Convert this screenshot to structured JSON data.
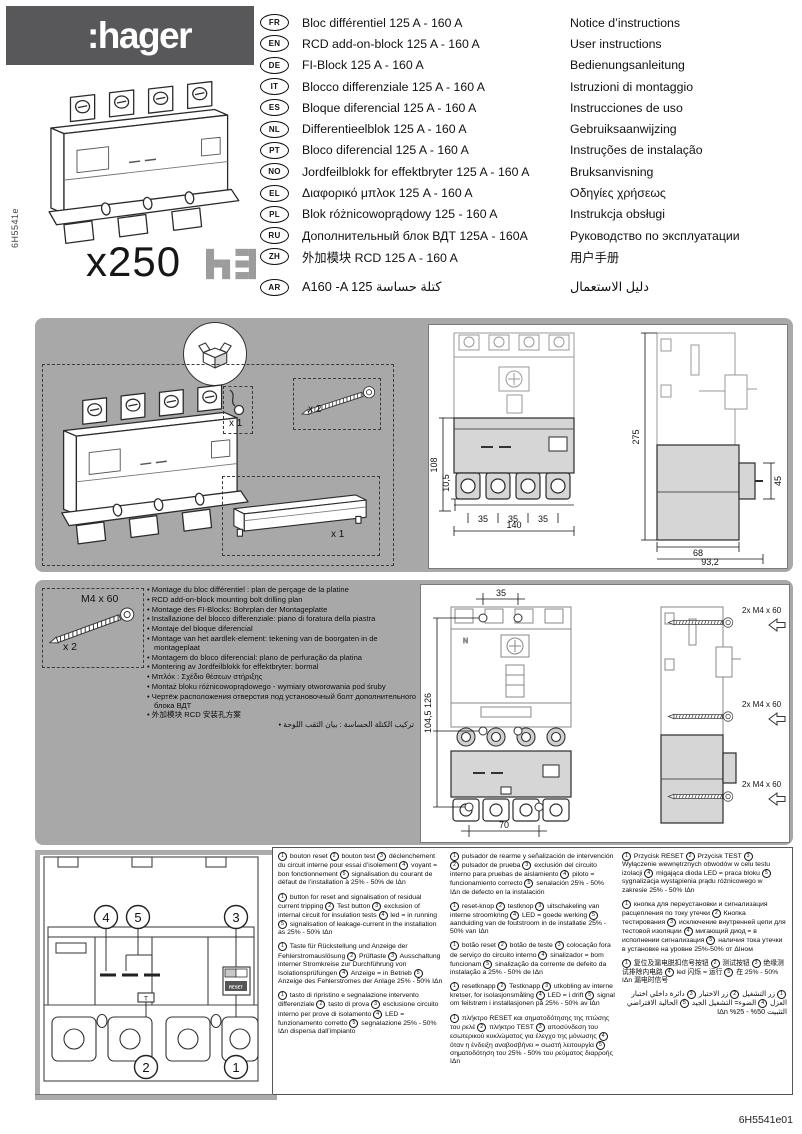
{
  "page": {
    "side_ref": "6H5541e",
    "footer_ref": "6H5541e01"
  },
  "header": {
    "brand": ":hager",
    "product_code": "x250",
    "range_logo": "h3"
  },
  "languages": [
    {
      "code": "FR",
      "product": "Bloc différentiel 125 A - 160 A",
      "manual": "Notice d’instructions"
    },
    {
      "code": "EN",
      "product": "RCD add-on-block 125 A - 160 A",
      "manual": "User instructions"
    },
    {
      "code": "DE",
      "product": "FI-Block 125 A - 160 A",
      "manual": "Bedienungsanleitung"
    },
    {
      "code": "IT",
      "product": "Blocco differenziale 125 A - 160 A",
      "manual": "Istruzioni di montaggio"
    },
    {
      "code": "ES",
      "product": "Bloque diferencial 125 A - 160 A",
      "manual": "Instrucciones de uso"
    },
    {
      "code": "NL",
      "product": "Differentieelblok 125 A - 160 A",
      "manual": "Gebruiksaanwijzing"
    },
    {
      "code": "PT",
      "product": "Bloco diferencial 125 A - 160 A",
      "manual": "Instruções de instalação"
    },
    {
      "code": "NO",
      "product": "Jordfeilblokk for effektbryter 125 A - 160 A",
      "manual": "Bruksanvisning"
    },
    {
      "code": "EL",
      "product": "Διαφορικό μπλοκ 125 A - 160 A",
      "manual": "Οδηγίες χρήσεως"
    },
    {
      "code": "PL",
      "product": "Blok różnicowoprądowy 125 - 160 A",
      "manual": "Instrukcja obsługi"
    },
    {
      "code": "RU",
      "product": "Дополнительный блок ВДТ 125А - 160А",
      "manual": "Руководство по эксплуатации"
    },
    {
      "code": "ZH",
      "product": "外加模块 RCD 125 A - 160 A",
      "manual": "用户手册"
    },
    {
      "code": "AR",
      "product": "A160 -A 125   كتلة حساسة",
      "manual": "دليل الاستعمال"
    }
  ],
  "kit": {
    "seal_qty": "x 1",
    "screws_qty": "x 2",
    "cover_qty": "x 1"
  },
  "dimensions": {
    "front_height": "108",
    "foot_offset": "10,5",
    "pole_pitch": [
      "35",
      "35",
      "35"
    ],
    "width": "140",
    "total_height": "275",
    "knob_height": "45",
    "depth": "68",
    "total_depth": "93,2"
  },
  "drilling": {
    "bolt_label": "M4 x 60",
    "bolt_qty": "x 2",
    "top_pitch": "35",
    "hole_spacing": "104,5 126",
    "bottom_pitch": "70",
    "screw_note": "2x M4 x 60",
    "bullets": [
      "Montage du bloc différentiel : plan de perçage de la platine",
      "RCD add-on-block mounting bolt drilling plan",
      "Montage des FI-Blocks: Bohrplan der Montageplatte",
      "Installazione del blocco differenziale: piano di foratura della piastra",
      "Montaje del bloque diferencial",
      "Montage van het aardlek-element: tekening van de boorgaten in de montageplaat",
      "Montagem do bloco diferencial: plano de perfuração da platina",
      "Montering av Jordfeilblokk for effektbryter: bormal",
      "Μπλόκ : Σχέδιο θέσεων στήριξης",
      "Montaż bloku różnicowoprądowego - wymiary otworowania pod śruby",
      "Чертёж расположения отверстия под установочный болт дополнительного блока ВДТ",
      "外加模块 RCD 安装孔方案",
      "تركيب الكتلة الحساسة : بيان الثقب اللوحة"
    ]
  },
  "panel": {
    "callouts": {
      "c1": "1",
      "c2": "2",
      "c3": "3",
      "c4": "4",
      "c5": "5"
    },
    "reset_label": "RESET",
    "test_label": "T"
  },
  "legends": [
    {
      "lang": "fr",
      "items": [
        {
          "n": "1",
          "t": "bouton reset"
        },
        {
          "n": "2",
          "t": "bouton test"
        },
        {
          "n": "3",
          "t": "déclenchement du circuit interne pour essai d’isolement"
        },
        {
          "n": "4",
          "t": "voyant = bon fonctionnement"
        },
        {
          "n": "5",
          "t": "signalisation du courant de défaut de l’installation à 25% - 50% de IΔn"
        }
      ]
    },
    {
      "lang": "en",
      "items": [
        {
          "n": "1",
          "t": "button for reset and signalisation of residual current tripping"
        },
        {
          "n": "2",
          "t": "Test button"
        },
        {
          "n": "3",
          "t": "exclusion of internal circuit for insulation tests"
        },
        {
          "n": "4",
          "t": "led = in running"
        },
        {
          "n": "5",
          "t": "signalisation of leakage-current in the installation as 25% - 50% IΔn"
        }
      ]
    },
    {
      "lang": "de",
      "items": [
        {
          "n": "1",
          "t": "Taste für Rückstellung und Anzeige der Fehlerstromauslösung"
        },
        {
          "n": "2",
          "t": "Prüftaste"
        },
        {
          "n": "3",
          "t": "Ausschaltung interner Stromkreise zur Durchführung von Isolationsprüfungen"
        },
        {
          "n": "4",
          "t": "Anzeige = in Betrieb"
        },
        {
          "n": "5",
          "t": "Anzeige des Fehlerstromes der Anlage 25% - 50% IΔn"
        }
      ]
    },
    {
      "lang": "it",
      "items": [
        {
          "n": "1",
          "t": "tasto di ripristino e segnalazione intervento differenziale"
        },
        {
          "n": "2",
          "t": "tasto di prova"
        },
        {
          "n": "3",
          "t": "esclusione circuito interno per prove di isolamento"
        },
        {
          "n": "4",
          "t": "LED = funzionamento corretto"
        },
        {
          "n": "5",
          "t": "segnalazione 25% - 50% IΔn dispersa dall’impianto"
        }
      ]
    },
    {
      "lang": "es",
      "items": [
        {
          "n": "1",
          "t": "pulsador de rearme y señalización de intervención"
        },
        {
          "n": "2",
          "t": "pulsador de prueba"
        },
        {
          "n": "3",
          "t": "exclusión del circuito interno para pruebas de aislamiento"
        },
        {
          "n": "4",
          "t": "piloto = funcionamiento correcto"
        },
        {
          "n": "5",
          "t": "senalación 25% - 50% IΔn de defecto en la instalación"
        }
      ]
    },
    {
      "lang": "nl",
      "items": [
        {
          "n": "1",
          "t": "reset-knop"
        },
        {
          "n": "2",
          "t": "testknop"
        },
        {
          "n": "3",
          "t": "uitschakeling van interne stroomkring"
        },
        {
          "n": "4",
          "t": "LED = goede werking"
        },
        {
          "n": "5",
          "t": "aanduiding van de foutstroom in de installatie 25% - 50% van IΔn"
        }
      ]
    },
    {
      "lang": "pt",
      "items": [
        {
          "n": "1",
          "t": "botão reset"
        },
        {
          "n": "2",
          "t": "botão de teste"
        },
        {
          "n": "3",
          "t": "colocação fora de serviço do circuito interno"
        },
        {
          "n": "4",
          "t": "sinalizador = bom funcionam"
        },
        {
          "n": "5",
          "t": "sinalização da corrente de defeito da instalação a 25% - 50% de IΔn"
        }
      ]
    },
    {
      "lang": "no",
      "items": [
        {
          "n": "1",
          "t": "resetknapp"
        },
        {
          "n": "2",
          "t": "Testknapp"
        },
        {
          "n": "3",
          "t": "utkobling av interne kretser, for isolasjonsmåling"
        },
        {
          "n": "4",
          "t": "LED = i drift"
        },
        {
          "n": "5",
          "t": "signal om feilstrøm i installasjonen på 25% - 50% av IΔn"
        }
      ]
    },
    {
      "lang": "el",
      "items": [
        {
          "n": "1",
          "t": "πλήκτρο RESET και σηματοδότησης της πτώσης του ρελέ"
        },
        {
          "n": "2",
          "t": "πλήκτρο TEST"
        },
        {
          "n": "3",
          "t": "αποσύνδεση του εσωτερικού κυκλώματος για έλεγχο της μόνωσης"
        },
        {
          "n": "4",
          "t": "όταν η ένδειξη αναβοσβήνει = σωστή λειτουργία"
        },
        {
          "n": "5",
          "t": "σηματοδότηση του 25% - 50% του ρεύματος διαρροής IΔn"
        }
      ]
    },
    {
      "lang": "pl",
      "items": [
        {
          "n": "1",
          "t": "Przycisk RESET"
        },
        {
          "n": "2",
          "t": "Przycisk TEST"
        },
        {
          "n": "3",
          "t": "Wyłączenie wewnętrznych obwodów w celu testu izolacji"
        },
        {
          "n": "4",
          "t": "migająca dioda LED = praca bloku"
        },
        {
          "n": "5",
          "t": "sygnalizacja wystąpienia prądu różnicowego w zakresie 25% - 50% IΔn"
        }
      ]
    },
    {
      "lang": "ru",
      "items": [
        {
          "n": "1",
          "t": "кнопка для переустановки и сигнализация расцепления по току утечки"
        },
        {
          "n": "2",
          "t": "Кнопка тестирования"
        },
        {
          "n": "3",
          "t": "исключение внутренней цепи для тестовой изоляции"
        },
        {
          "n": "4",
          "t": "мигающий диод = в исполнении сигнализация"
        },
        {
          "n": "5",
          "t": "наличия тока утечки в установке на уровне 25%-50% от ΔIном"
        }
      ]
    },
    {
      "lang": "zh",
      "items": [
        {
          "n": "1",
          "t": "复位及漏电脱扣信号按钮"
        },
        {
          "n": "2",
          "t": "测试按钮"
        },
        {
          "n": "3",
          "t": "绝缘测试排除内电路"
        },
        {
          "n": "4",
          "t": "led 闪烁 = 运行"
        },
        {
          "n": "5",
          "t": "在 25% - 50% IΔn 漏电时信号"
        }
      ]
    },
    {
      "lang": "ar",
      "items": [
        {
          "n": "1",
          "t": "زر التشغيل"
        },
        {
          "n": "2",
          "t": "زر الاختبار"
        },
        {
          "n": "3",
          "t": "دائرة داخلي اختبار العزل"
        },
        {
          "n": "4",
          "t": "الضوء= التشغيل الجيد"
        },
        {
          "n": "5",
          "t": "الحالية الافتراضي التثبيت 50% - 25% IΔn"
        }
      ]
    }
  ],
  "legend_columns": [
    [
      0,
      1,
      2,
      3
    ],
    [
      4,
      5,
      6,
      7,
      8
    ],
    [
      9,
      10,
      11,
      12
    ]
  ]
}
